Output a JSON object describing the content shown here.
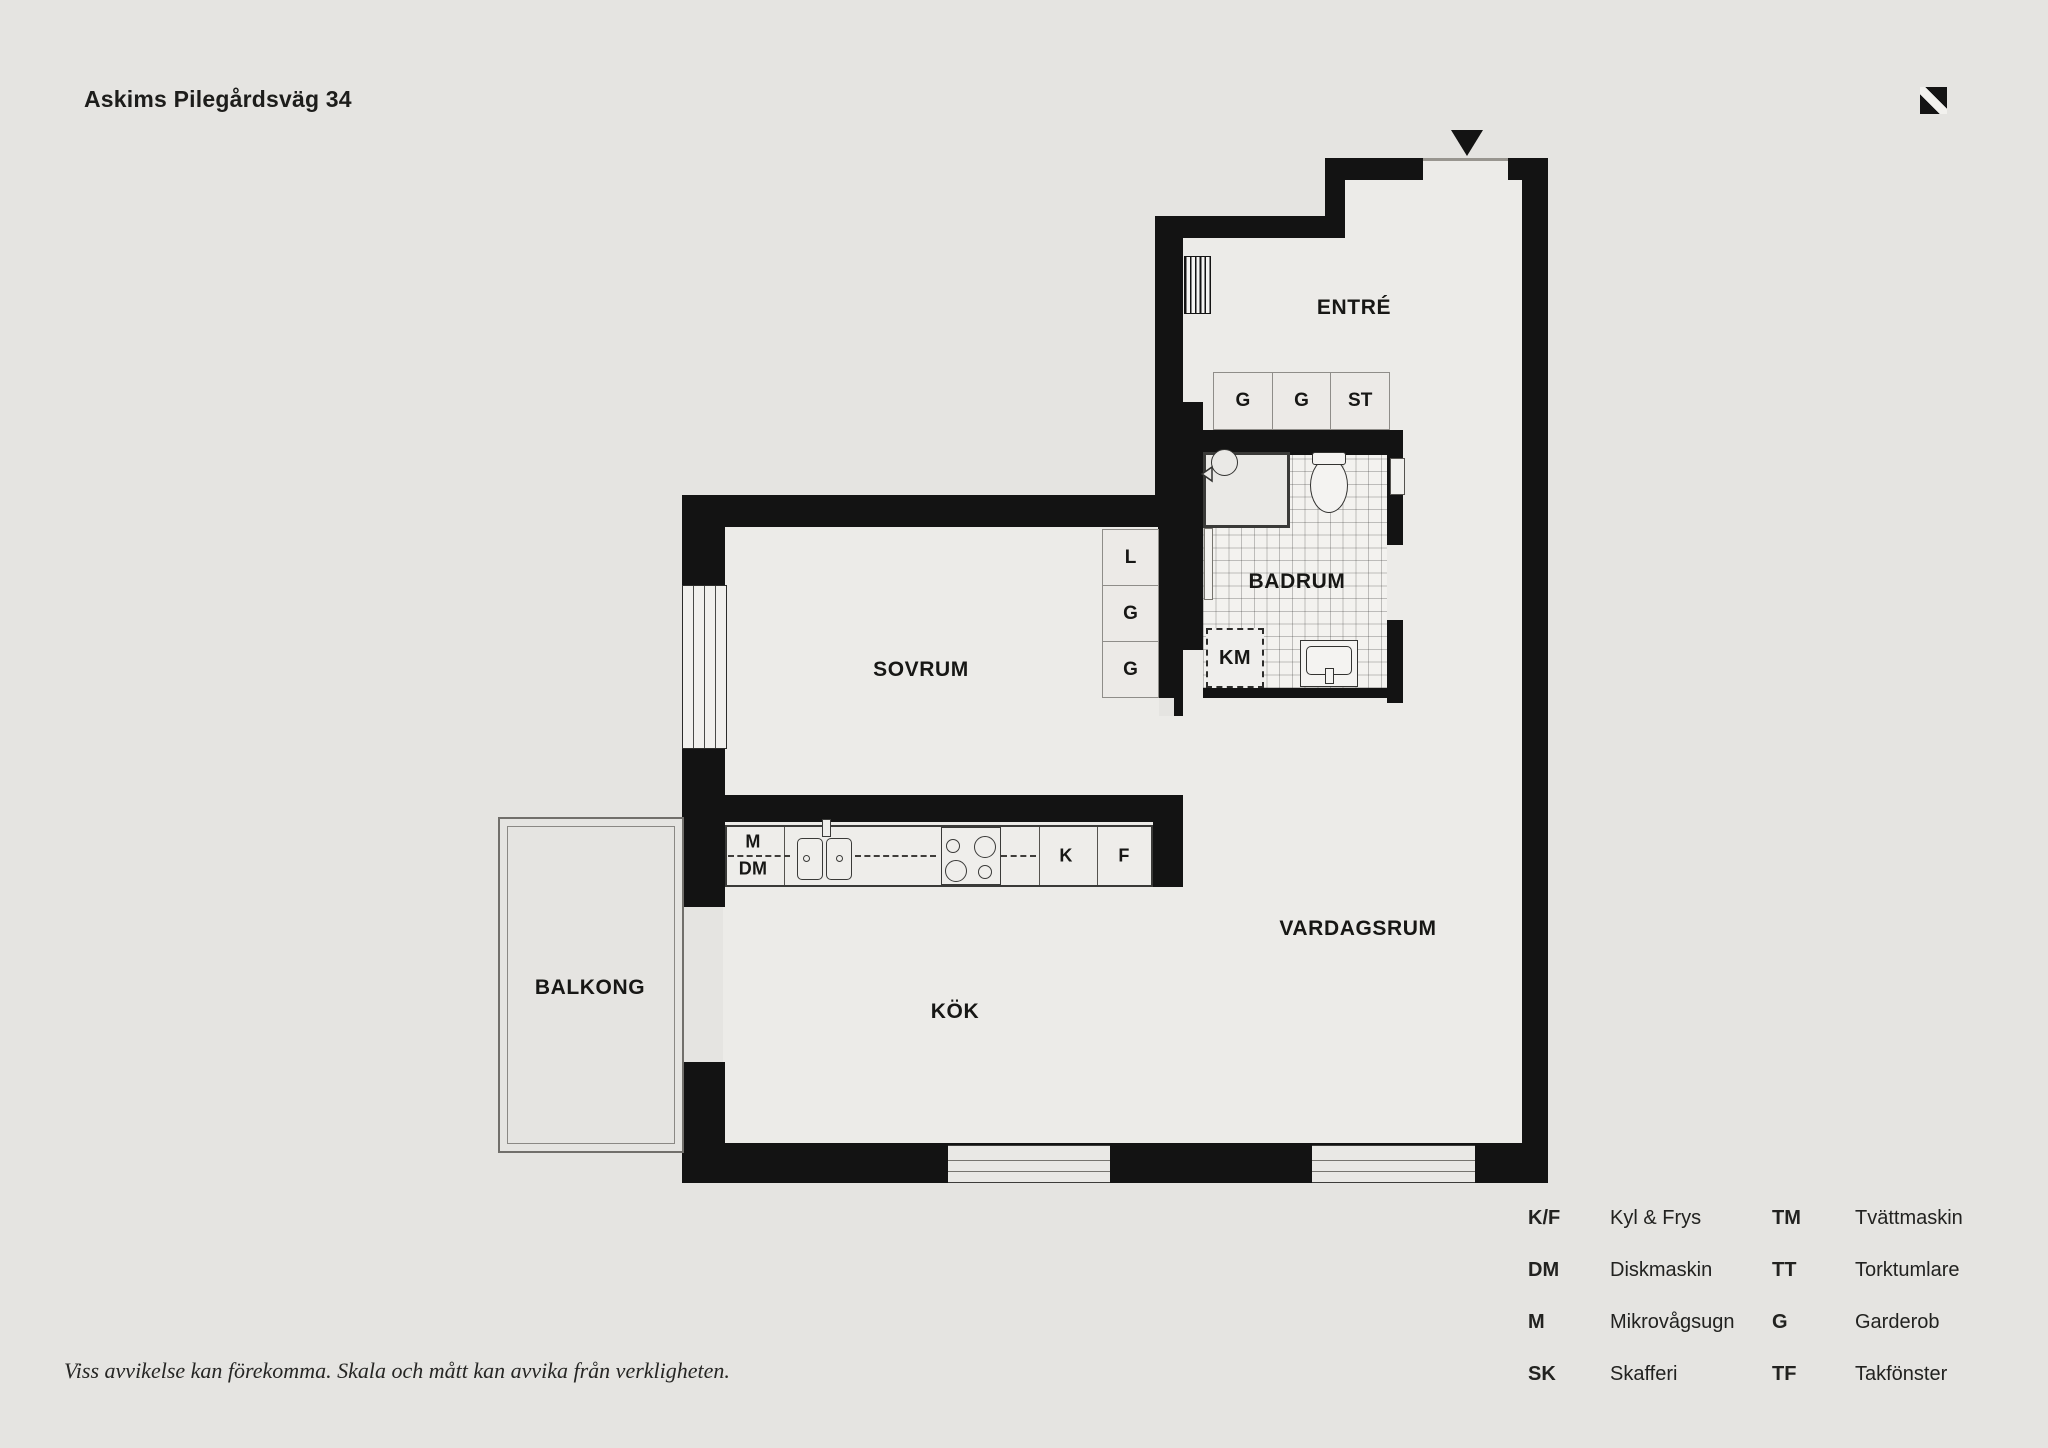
{
  "header": {
    "title": "Askims Pilegårdsväg 34"
  },
  "plan": {
    "rooms": {
      "entre": "ENTRÉ",
      "badrum": "BADRUM",
      "sovrum": "SOVRUM",
      "vardagsrum": "VARDAGSRUM",
      "kok": "KÖK",
      "balkong": "BALKONG"
    },
    "fixtures": {
      "km": "KM",
      "m": "M",
      "dm": "DM",
      "k": "K",
      "f": "F"
    },
    "entre_closets": [
      "G",
      "G",
      "ST"
    ],
    "sovrum_closets": [
      "L",
      "G",
      "G"
    ]
  },
  "legend": {
    "items": [
      {
        "abbr": "K/F",
        "label": "Kyl & Frys"
      },
      {
        "abbr": "DM",
        "label": "Diskmaskin"
      },
      {
        "abbr": "M",
        "label": "Mikrovågsugn"
      },
      {
        "abbr": "SK",
        "label": "Skafferi"
      },
      {
        "abbr": "TM",
        "label": "Tvättmaskin"
      },
      {
        "abbr": "TT",
        "label": "Torktumlare"
      },
      {
        "abbr": "G",
        "label": "Garderob"
      },
      {
        "abbr": "TF",
        "label": "Takfönster"
      }
    ]
  },
  "footer": {
    "disclaimer": "Viss avvikelse kan förekomma. Skala och mått kan avvika från verkligheten."
  },
  "colors": {
    "background": "#e5e4e1",
    "floor": "#ecebe8",
    "wall": "#131313",
    "bathroom_floor": "#f3f2ef",
    "outline": "#3a3a38",
    "text": "#1b1b19"
  }
}
